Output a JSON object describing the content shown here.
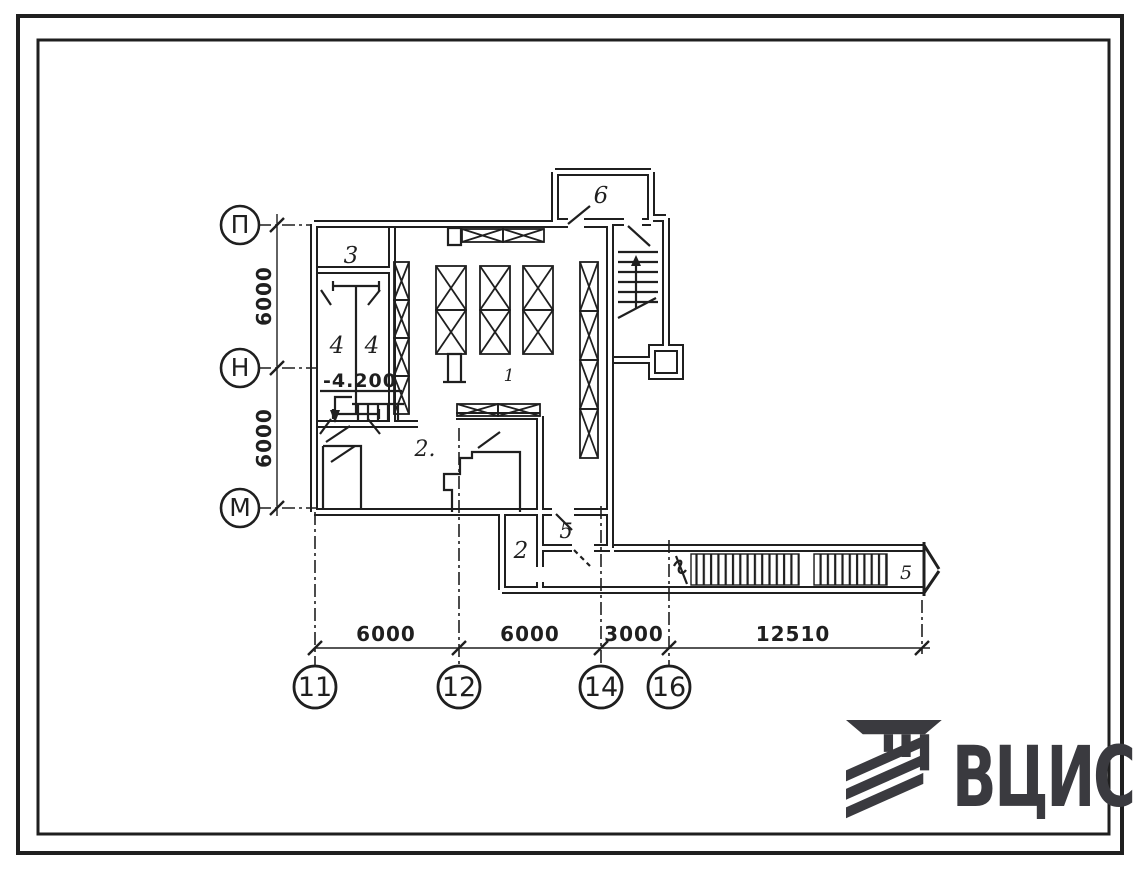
{
  "plan": {
    "row_axes": [
      "П",
      "Н",
      "М"
    ],
    "col_axes": [
      "11",
      "12",
      "14",
      "16"
    ],
    "vertical_dims": [
      "6000",
      "6000"
    ],
    "horizontal_dims": [
      "6000",
      "6000",
      "3000",
      "12510"
    ],
    "elevation": "-4.200",
    "room_labels": {
      "hall": "1",
      "room2_main": "2.",
      "room2_annex": "2",
      "room3": "3",
      "room4_left": "4",
      "room4_right": "4",
      "room5_annex": "5",
      "room6_vestibule": "6",
      "tunnel": "5"
    }
  },
  "logo": {
    "text": "ВЦИС"
  },
  "colors": {
    "ink": "#1f1f1f",
    "logo": "#3a3a3f",
    "paper": "#ffffff"
  }
}
